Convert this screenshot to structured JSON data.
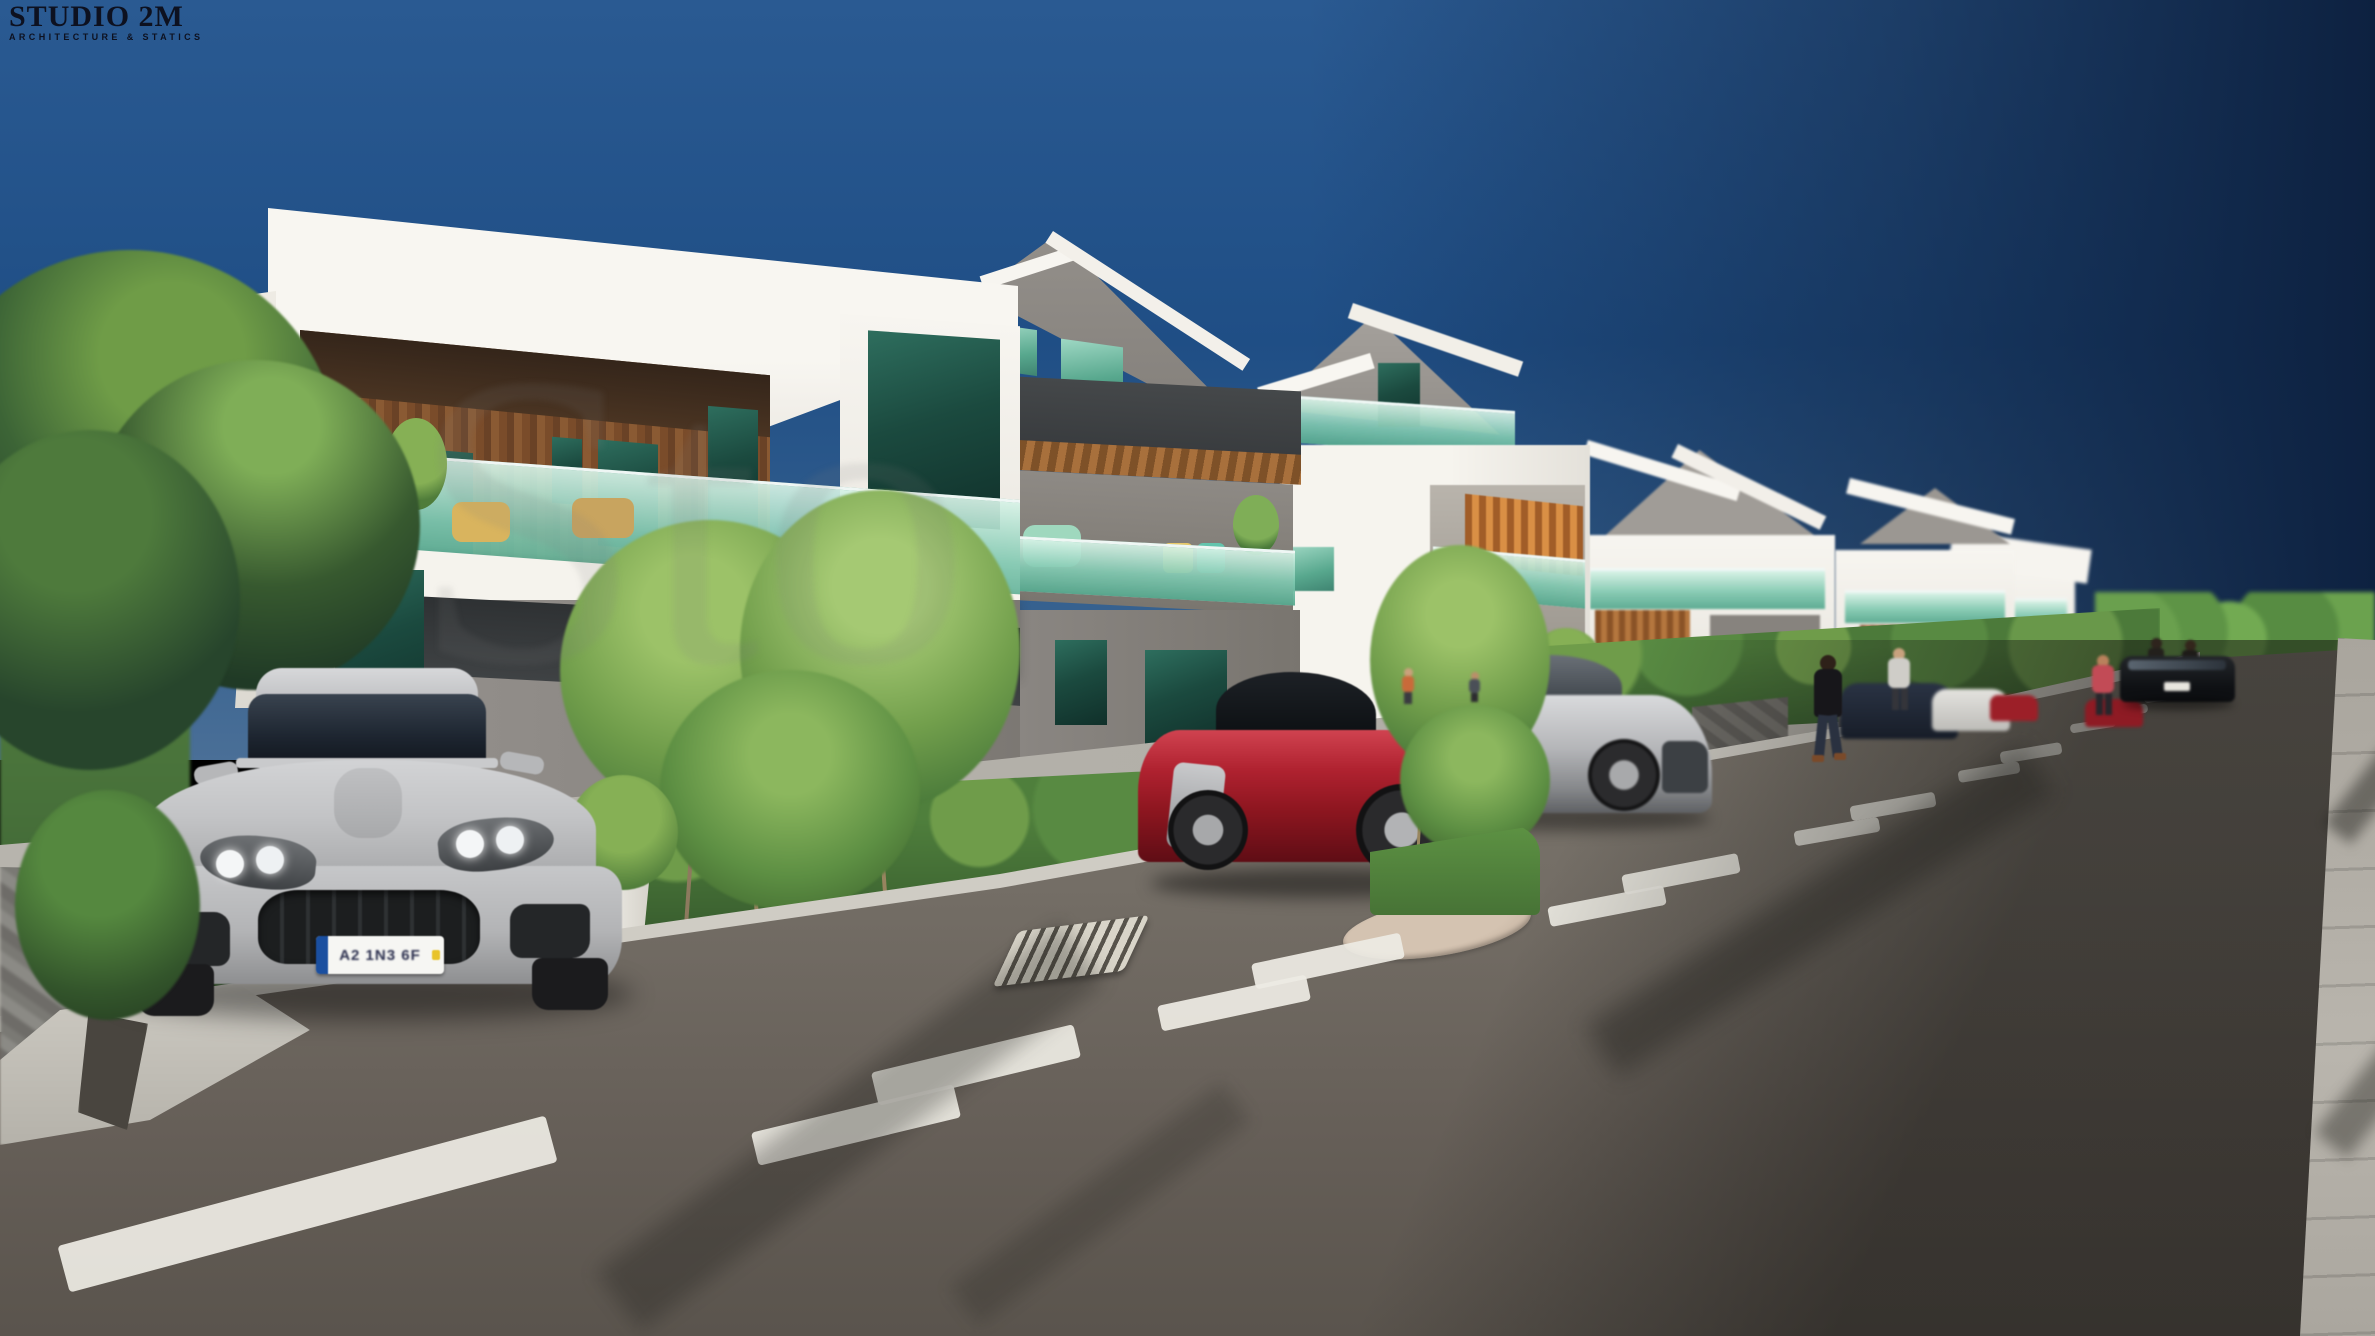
{
  "branding": {
    "title": "STUDIO 2M",
    "subtitle": "ARCHITECTURE & STATICS"
  },
  "watermark": {
    "text": "Sto"
  },
  "vehicles": {
    "front_plate": "A2 1N3 6F"
  },
  "colors": {
    "sky_top": "#2a5a92",
    "sky_deep": "#1f4e85",
    "sky_right_dark": "#0d2140",
    "facade_white": "#f4f2ec",
    "facade_shade": "#d9d6cf",
    "charcoal": "#3a3d3f",
    "wood": "#8a5a33",
    "wood_dark": "#42301f",
    "accent_teal": "#6cbca2",
    "glass_dark": "#1b4a3f",
    "wall_gray": "#908c88",
    "hedge_green": "#4a7a3a",
    "tree_dark": "#24402a",
    "tree_light": "#86b04e",
    "grass": "#5c8f42",
    "sidewalk": "#b4b1aa",
    "curb": "#cfccc4",
    "asphalt": "#6f6962",
    "road_line": "#edebe3",
    "stone": "#7e7c78",
    "red_car": "#a31722",
    "silver_car": "#bfc0c2",
    "manhole": "#cab8a6",
    "plate_blue": "#1a4fa0"
  }
}
